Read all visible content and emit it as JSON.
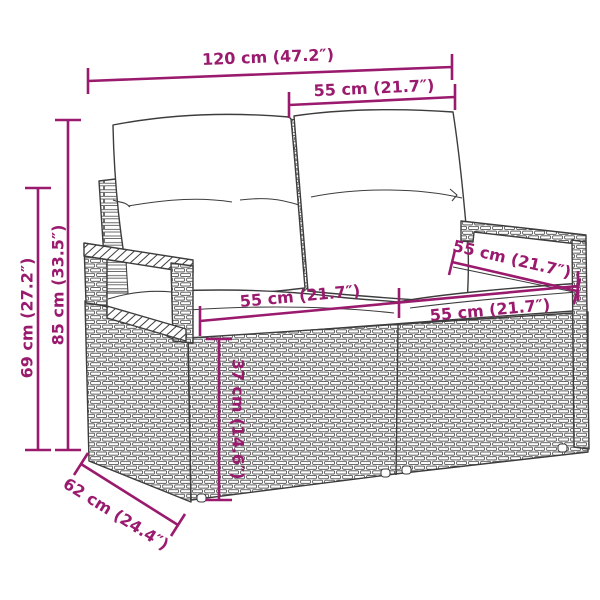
{
  "colors": {
    "accent": "#9a1a6e",
    "line": "#3d3d3d",
    "background": "#ffffff"
  },
  "diagram": {
    "labels": {
      "overall_width": "120 cm (47.2″)",
      "backrest_width": "55 cm (21.7″)",
      "overall_height": "85 cm (33.5″)",
      "armrest_height": "69 cm (27.2″)",
      "seat_width_left": "55 cm (21.7″)",
      "seat_width_right": "55 cm (21.7″)",
      "seat_depth": "55 cm (21.7″)",
      "base_height": "37 cm (14.6″)",
      "overall_depth": "62 cm (24.4″)"
    }
  }
}
